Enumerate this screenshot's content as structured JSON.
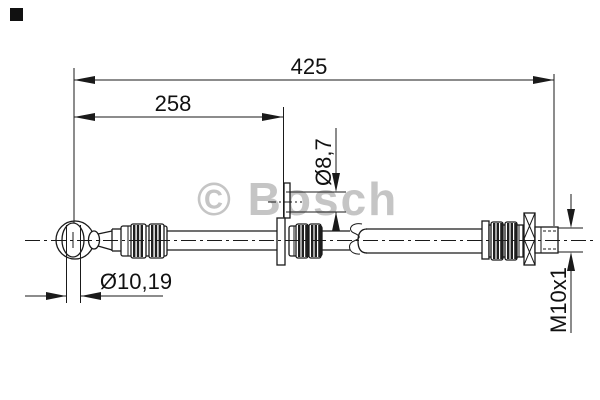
{
  "watermark": {
    "text": "© Bosch",
    "color": "#c5c5c5"
  },
  "dimensions": {
    "overall_length": "425",
    "intermediate_length": "258",
    "bracket_hole_diameter": "Ø8,7",
    "banjo_eye_diameter": "Ø10,19",
    "thread_size": "M10x1"
  },
  "colors": {
    "line": "#1a1a1a",
    "watermark": "#c5c5c5",
    "background": "#ffffff"
  }
}
